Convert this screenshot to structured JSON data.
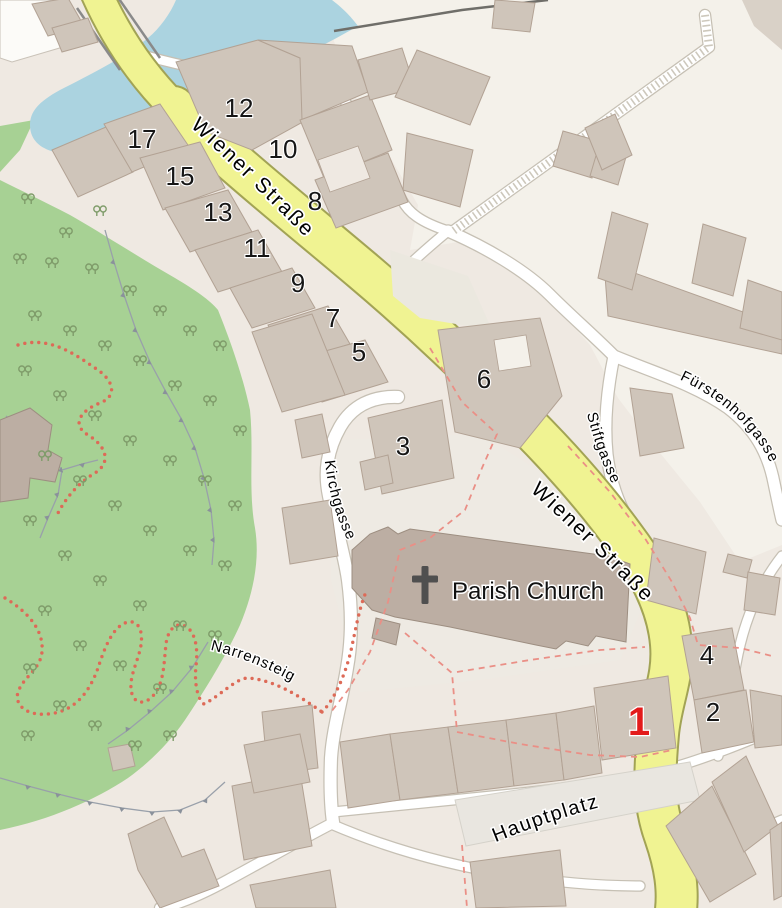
{
  "map": {
    "streets": [
      {
        "id": "wiener-strasse-upper",
        "name": "Wiener Straße"
      },
      {
        "id": "wiener-strasse-lower",
        "name": "Wiener Straße"
      },
      {
        "id": "stiftgasse",
        "name": "Stiftgasse"
      },
      {
        "id": "fuerstenhofgasse",
        "name": "Fürstenhofgasse"
      },
      {
        "id": "kirchgasse",
        "name": "Kirchgasse"
      },
      {
        "id": "narrensteig",
        "name": "Narrensteig"
      },
      {
        "id": "hauptplatz",
        "name": "Hauptplatz"
      }
    ],
    "poi": {
      "parish_church": "Parish Church"
    },
    "building_numbers": [
      {
        "value": "12"
      },
      {
        "value": "17"
      },
      {
        "value": "10"
      },
      {
        "value": "15"
      },
      {
        "value": "8"
      },
      {
        "value": "13"
      },
      {
        "value": "11"
      },
      {
        "value": "9"
      },
      {
        "value": "7"
      },
      {
        "value": "5"
      },
      {
        "value": "6"
      },
      {
        "value": "3"
      },
      {
        "value": "4"
      },
      {
        "value": "2"
      }
    ],
    "highlighted_number": {
      "value": "1",
      "color": "#e31b1b"
    },
    "colors": {
      "road_primary": "#f0f392",
      "road_primary_casing": "#a2a355",
      "park": "#a7d194",
      "water": "#abd3e0",
      "building": "#cfc5ba",
      "church_building": "#bcaea3",
      "boundary_dash": "#ea8f86",
      "path_dots": "#dd6a57",
      "highlight": "#e31b1b"
    }
  }
}
